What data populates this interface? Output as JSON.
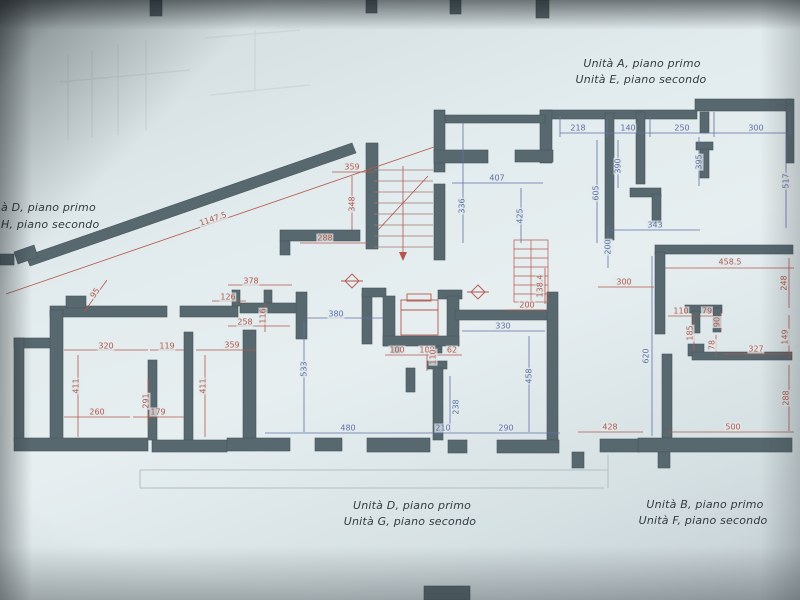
{
  "unit_labels": {
    "top_right": {
      "line1": "Unità A, piano primo",
      "line2": "Unità E, piano secondo"
    },
    "left": {
      "line1": "à D, piano primo",
      "line2": "H, piano secondo"
    },
    "bottom_center": {
      "line1": "Unità D, piano primo",
      "line2": "Unità G, piano secondo"
    },
    "bottom_right": {
      "line1": "Unità B, piano primo",
      "line2": "Unità F, piano secondo"
    }
  },
  "colors": {
    "paper": "#dde7e9",
    "wall": "#58686f",
    "dim_blue": "#5f70a8",
    "dim_red": "#b4584e",
    "label_text": "#333b40"
  },
  "dimensions": [
    {
      "text": "218",
      "x": 578,
      "y": 128,
      "rot": 0,
      "color": "blue"
    },
    {
      "text": "140",
      "x": 628,
      "y": 128,
      "rot": 0,
      "color": "blue"
    },
    {
      "text": "250",
      "x": 682,
      "y": 128,
      "rot": 0,
      "color": "blue"
    },
    {
      "text": "300",
      "x": 756,
      "y": 128,
      "rot": 0,
      "color": "blue"
    },
    {
      "text": "390",
      "x": 618,
      "y": 166,
      "rot": -90,
      "color": "blue"
    },
    {
      "text": "605",
      "x": 596,
      "y": 193,
      "rot": -90,
      "color": "blue"
    },
    {
      "text": "395",
      "x": 699,
      "y": 162,
      "rot": -90,
      "color": "blue"
    },
    {
      "text": "343",
      "x": 655,
      "y": 225,
      "rot": 0,
      "color": "blue"
    },
    {
      "text": "517",
      "x": 786,
      "y": 181,
      "rot": -90,
      "color": "blue"
    },
    {
      "text": "407",
      "x": 497,
      "y": 178,
      "rot": 0,
      "color": "blue"
    },
    {
      "text": "336",
      "x": 462,
      "y": 206,
      "rot": -90,
      "color": "blue"
    },
    {
      "text": "425",
      "x": 520,
      "y": 216,
      "rot": -90,
      "color": "blue"
    },
    {
      "text": "330",
      "x": 503,
      "y": 326,
      "rot": 0,
      "color": "blue"
    },
    {
      "text": "458",
      "x": 529,
      "y": 376,
      "rot": -90,
      "color": "blue"
    },
    {
      "text": "380",
      "x": 336,
      "y": 314,
      "rot": 0,
      "color": "blue"
    },
    {
      "text": "533",
      "x": 304,
      "y": 369,
      "rot": -90,
      "color": "blue"
    },
    {
      "text": "480",
      "x": 348,
      "y": 428,
      "rot": 0,
      "color": "blue"
    },
    {
      "text": "210",
      "x": 443,
      "y": 428,
      "rot": 0,
      "color": "blue"
    },
    {
      "text": "290",
      "x": 506,
      "y": 428,
      "rot": 0,
      "color": "blue"
    },
    {
      "text": "238",
      "x": 456,
      "y": 407,
      "rot": -90,
      "color": "blue"
    },
    {
      "text": "620",
      "x": 646,
      "y": 356,
      "rot": -90,
      "color": "blue"
    },
    {
      "text": "200",
      "x": 608,
      "y": 247,
      "rot": -90,
      "color": "blue"
    },
    {
      "text": "359",
      "x": 352,
      "y": 167,
      "rot": 0,
      "color": "red"
    },
    {
      "text": "348",
      "x": 352,
      "y": 204,
      "rot": -90,
      "color": "red"
    },
    {
      "text": "288",
      "x": 325,
      "y": 238,
      "rot": 0,
      "color": "red"
    },
    {
      "text": "1147.5",
      "x": 213,
      "y": 219,
      "rot": -19,
      "color": "red"
    },
    {
      "text": "95",
      "x": 95,
      "y": 293,
      "rot": -55,
      "color": "red"
    },
    {
      "text": "378",
      "x": 251,
      "y": 281,
      "rot": 0,
      "color": "red"
    },
    {
      "text": "126",
      "x": 228,
      "y": 297,
      "rot": 0,
      "color": "red"
    },
    {
      "text": "116",
      "x": 263,
      "y": 316,
      "rot": -90,
      "color": "red"
    },
    {
      "text": "258",
      "x": 245,
      "y": 322,
      "rot": 0,
      "color": "red"
    },
    {
      "text": "320",
      "x": 106,
      "y": 346,
      "rot": 0,
      "color": "red"
    },
    {
      "text": "119",
      "x": 167,
      "y": 346,
      "rot": 0,
      "color": "red"
    },
    {
      "text": "359",
      "x": 232,
      "y": 345,
      "rot": 0,
      "color": "red"
    },
    {
      "text": "411",
      "x": 76,
      "y": 386,
      "rot": -90,
      "color": "red"
    },
    {
      "text": "411",
      "x": 203,
      "y": 386,
      "rot": -90,
      "color": "red"
    },
    {
      "text": "291",
      "x": 146,
      "y": 401,
      "rot": -90,
      "color": "red"
    },
    {
      "text": "260",
      "x": 97,
      "y": 412,
      "rot": 0,
      "color": "red"
    },
    {
      "text": "179",
      "x": 158,
      "y": 412,
      "rot": 0,
      "color": "red"
    },
    {
      "text": "100",
      "x": 397,
      "y": 350,
      "rot": 0,
      "color": "red"
    },
    {
      "text": "108",
      "x": 427,
      "y": 350,
      "rot": 0,
      "color": "red"
    },
    {
      "text": "62",
      "x": 452,
      "y": 350,
      "rot": 0,
      "color": "red"
    },
    {
      "text": "110",
      "x": 433,
      "y": 357,
      "rot": -90,
      "color": "red"
    },
    {
      "text": "200",
      "x": 527,
      "y": 305,
      "rot": 0,
      "color": "red"
    },
    {
      "text": "138.4",
      "x": 540,
      "y": 286,
      "rot": -90,
      "color": "red"
    },
    {
      "text": "458.5",
      "x": 730,
      "y": 262,
      "rot": 0,
      "color": "red"
    },
    {
      "text": "300",
      "x": 624,
      "y": 282,
      "rot": 0,
      "color": "red"
    },
    {
      "text": "248",
      "x": 784,
      "y": 283,
      "rot": -90,
      "color": "red"
    },
    {
      "text": "110",
      "x": 681,
      "y": 311,
      "rot": 0,
      "color": "red"
    },
    {
      "text": "79",
      "x": 707,
      "y": 311,
      "rot": 0,
      "color": "red"
    },
    {
      "text": "90",
      "x": 717,
      "y": 322,
      "rot": -90,
      "color": "red"
    },
    {
      "text": "185",
      "x": 690,
      "y": 333,
      "rot": -90,
      "color": "red"
    },
    {
      "text": "78",
      "x": 712,
      "y": 345,
      "rot": -90,
      "color": "red"
    },
    {
      "text": "327",
      "x": 756,
      "y": 349,
      "rot": 0,
      "color": "red"
    },
    {
      "text": "149",
      "x": 785,
      "y": 337,
      "rot": -90,
      "color": "red"
    },
    {
      "text": "288",
      "x": 786,
      "y": 398,
      "rot": -90,
      "color": "red"
    },
    {
      "text": "428",
      "x": 610,
      "y": 427,
      "rot": 0,
      "color": "red"
    },
    {
      "text": "500",
      "x": 733,
      "y": 427,
      "rot": 0,
      "color": "red"
    }
  ]
}
